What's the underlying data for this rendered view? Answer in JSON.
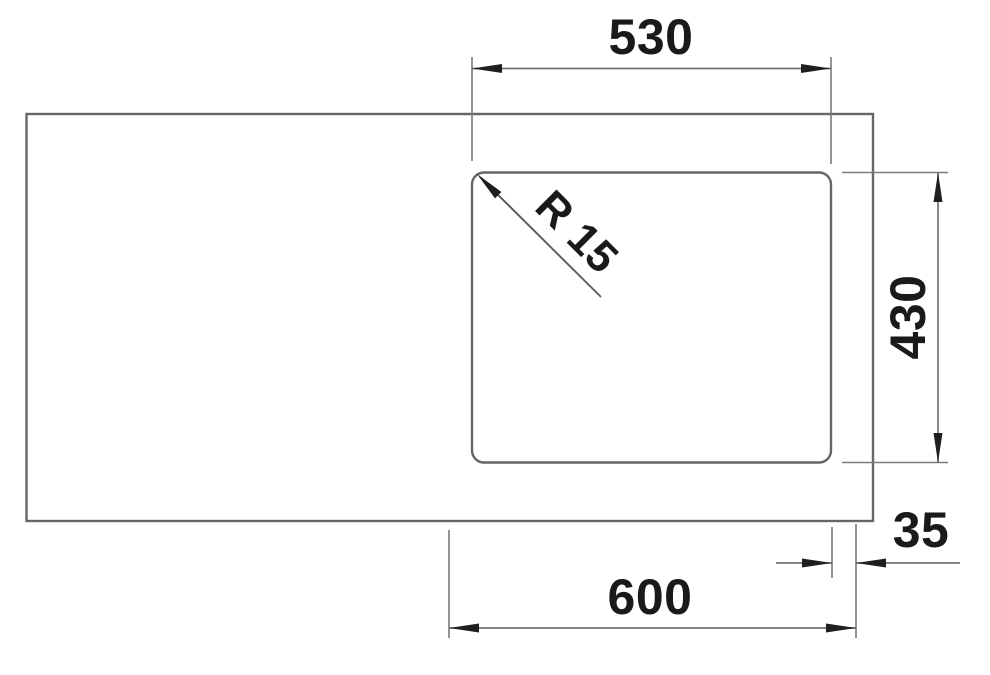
{
  "page": {
    "background": "#ffffff"
  },
  "colors": {
    "outline": "#666666",
    "dimension_line": "#737373",
    "ink": "#1a1a1a"
  },
  "drawing": {
    "type": "technical-dimension-drawing",
    "description_visible_shapes": "countertop rectangle with rounded-corner sink bowl cutout at right side",
    "dimensions": [
      {
        "id": "bowl-width-top",
        "label": "530"
      },
      {
        "id": "bowl-depth-right",
        "label": "430"
      },
      {
        "id": "corner-radius",
        "label": "R 15"
      },
      {
        "id": "edge-offset",
        "label": "35"
      },
      {
        "id": "cabinet-width",
        "label": "600"
      }
    ]
  }
}
